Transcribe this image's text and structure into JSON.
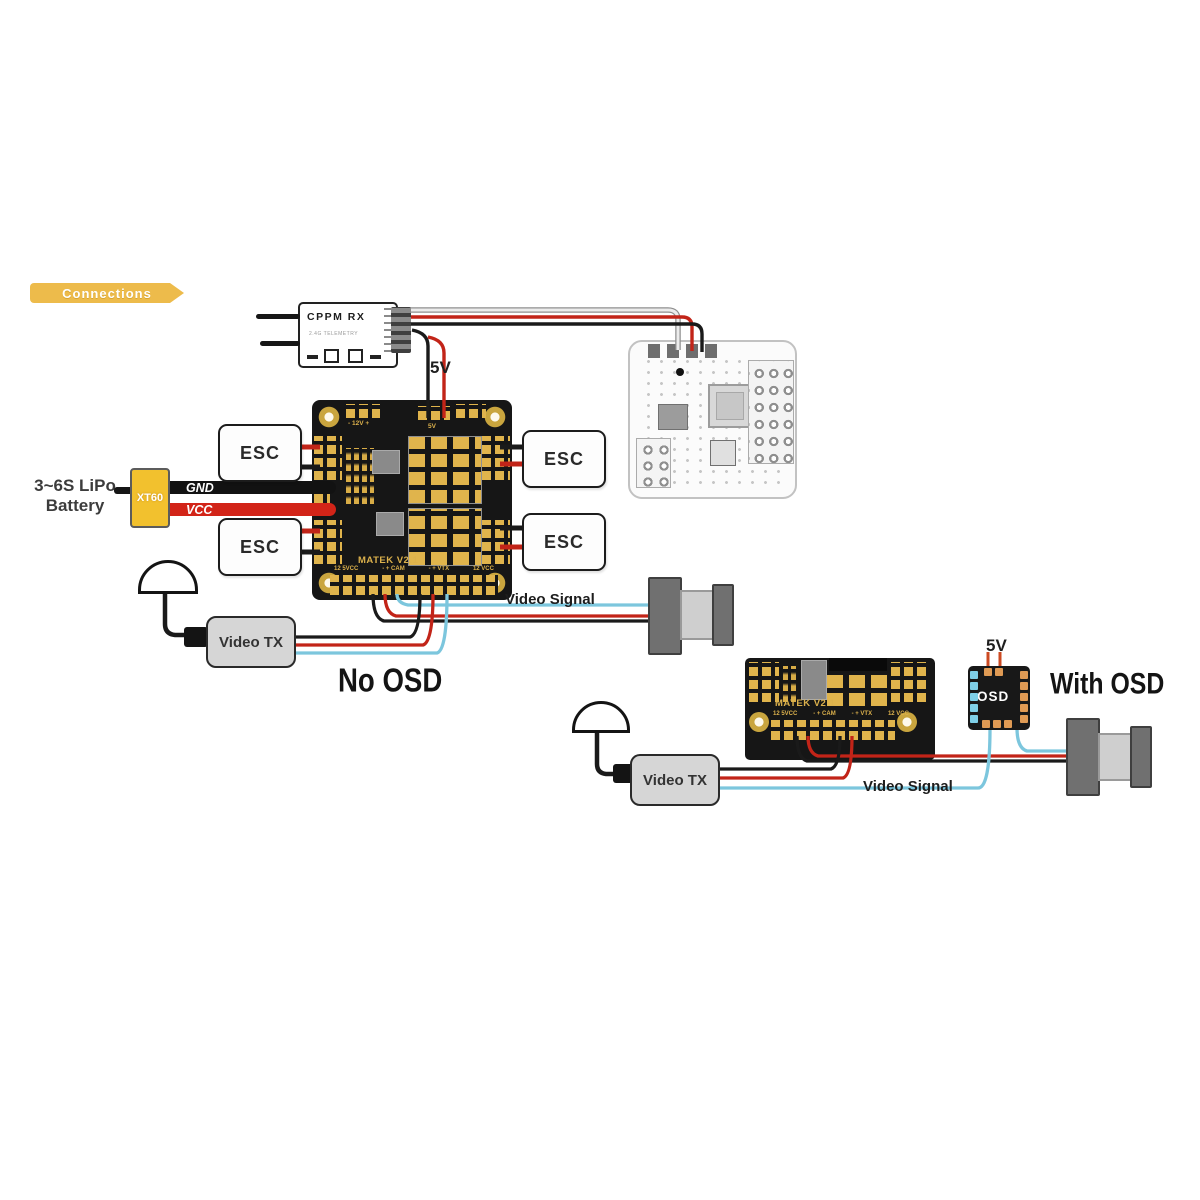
{
  "banner": {
    "label": "Connections"
  },
  "rx": {
    "title": "CPPM RX",
    "subtitle": "2.4G TELEMETRY"
  },
  "power": {
    "rx_supply": "5V",
    "battery_label": "3~6S LiPo Battery",
    "connector": "XT60",
    "gnd": "GND",
    "vcc": "VCC"
  },
  "esc_labels": [
    "ESC",
    "ESC",
    "ESC",
    "ESC"
  ],
  "board_main": {
    "name": "MATEK V2.1",
    "top_left_label": "- 12V +",
    "top_mid_label": "5V",
    "bottom_labels": [
      "12 5VCC",
      "- + CAM",
      "- + VTX",
      "12 VCC"
    ]
  },
  "board_small": {
    "name": "MATEK V2.1",
    "bottom_labels": [
      "12 5VCC",
      "- + CAM",
      "- + VTX",
      "12 VCC"
    ]
  },
  "video": {
    "tx1": "Video TX",
    "tx2": "Video TX",
    "signal1": "Video Signal",
    "signal2": "Video Signal"
  },
  "osd": {
    "chip": "OSD",
    "supply": "5V",
    "no_label": "No OSD",
    "with_label": "With OSD"
  },
  "colors": {
    "banner": "#edbb4b",
    "board": "#161616",
    "gold": "#e0b44c",
    "wire_red": "#c22418",
    "wire_black": "#1a1a1a",
    "wire_video": "#7cc6dd",
    "wire_light": "#ececec",
    "wire_light_outline": "#8f8f8f",
    "wire_orange": "#cc4a22"
  }
}
